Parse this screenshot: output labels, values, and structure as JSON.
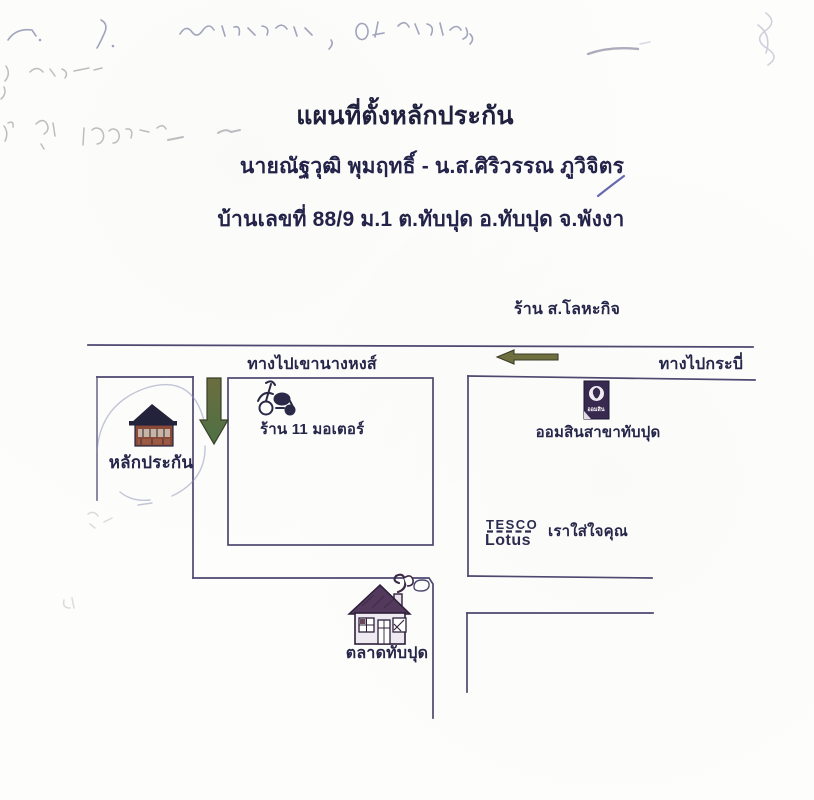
{
  "doc": {
    "title": "แผนที่ตั้งหลักประกัน",
    "owners": "นายณัฐวุฒิ พุมฤทธิ์ - น.ส.ศิริวรรณ  ภูวิจิตร",
    "address": "บ้านเลขที่ 88/9 ม.1 ต.ทับปุด อ.ทับปุด จ.พังงา"
  },
  "map": {
    "labels": {
      "metal_shop": "ร้าน ส.โลหะกิจ",
      "road_west": "ทางไปเขานางหงส์",
      "road_east": "ทางไปกระบี่",
      "motor_shop": "ร้าน 11 มอเตอร์",
      "bank_branch": "ออมสินสาขาทับปุด",
      "bank_logo_text": "ออมสิน",
      "collateral": "หลักประกัน",
      "tesco": "TESCO",
      "lotus": "Lotus",
      "tesco_slogan": "เราใส่ใจคุณ",
      "market": "ตลาดทับปุด"
    },
    "icons": {
      "collateral_house": "house-icon",
      "motorcycle": "motorcycle-icon",
      "gsb_bank": "gsb-bank-logo-icon",
      "market_house": "house-icon",
      "route_down": "down-arrow-icon",
      "route_left": "left-arrow-icon"
    }
  },
  "handwriting": {
    "description": "Faint illegible pen and pencil scribbles along the top margin and upper-left margin of the scan, a short blue pen tick after the owners' names, and a light hand-drawn circle around the collateral house on the map."
  },
  "colors": {
    "ink": "#26264a",
    "map_line": "#4c4870",
    "arrow_green": "#5c7040",
    "arrow_olive": "#6f7040",
    "gsb_purple": "#38294e",
    "house_red": "#8a4a38",
    "pen_blue": "#666a95",
    "pencil_gray": "#9b9ba3"
  }
}
